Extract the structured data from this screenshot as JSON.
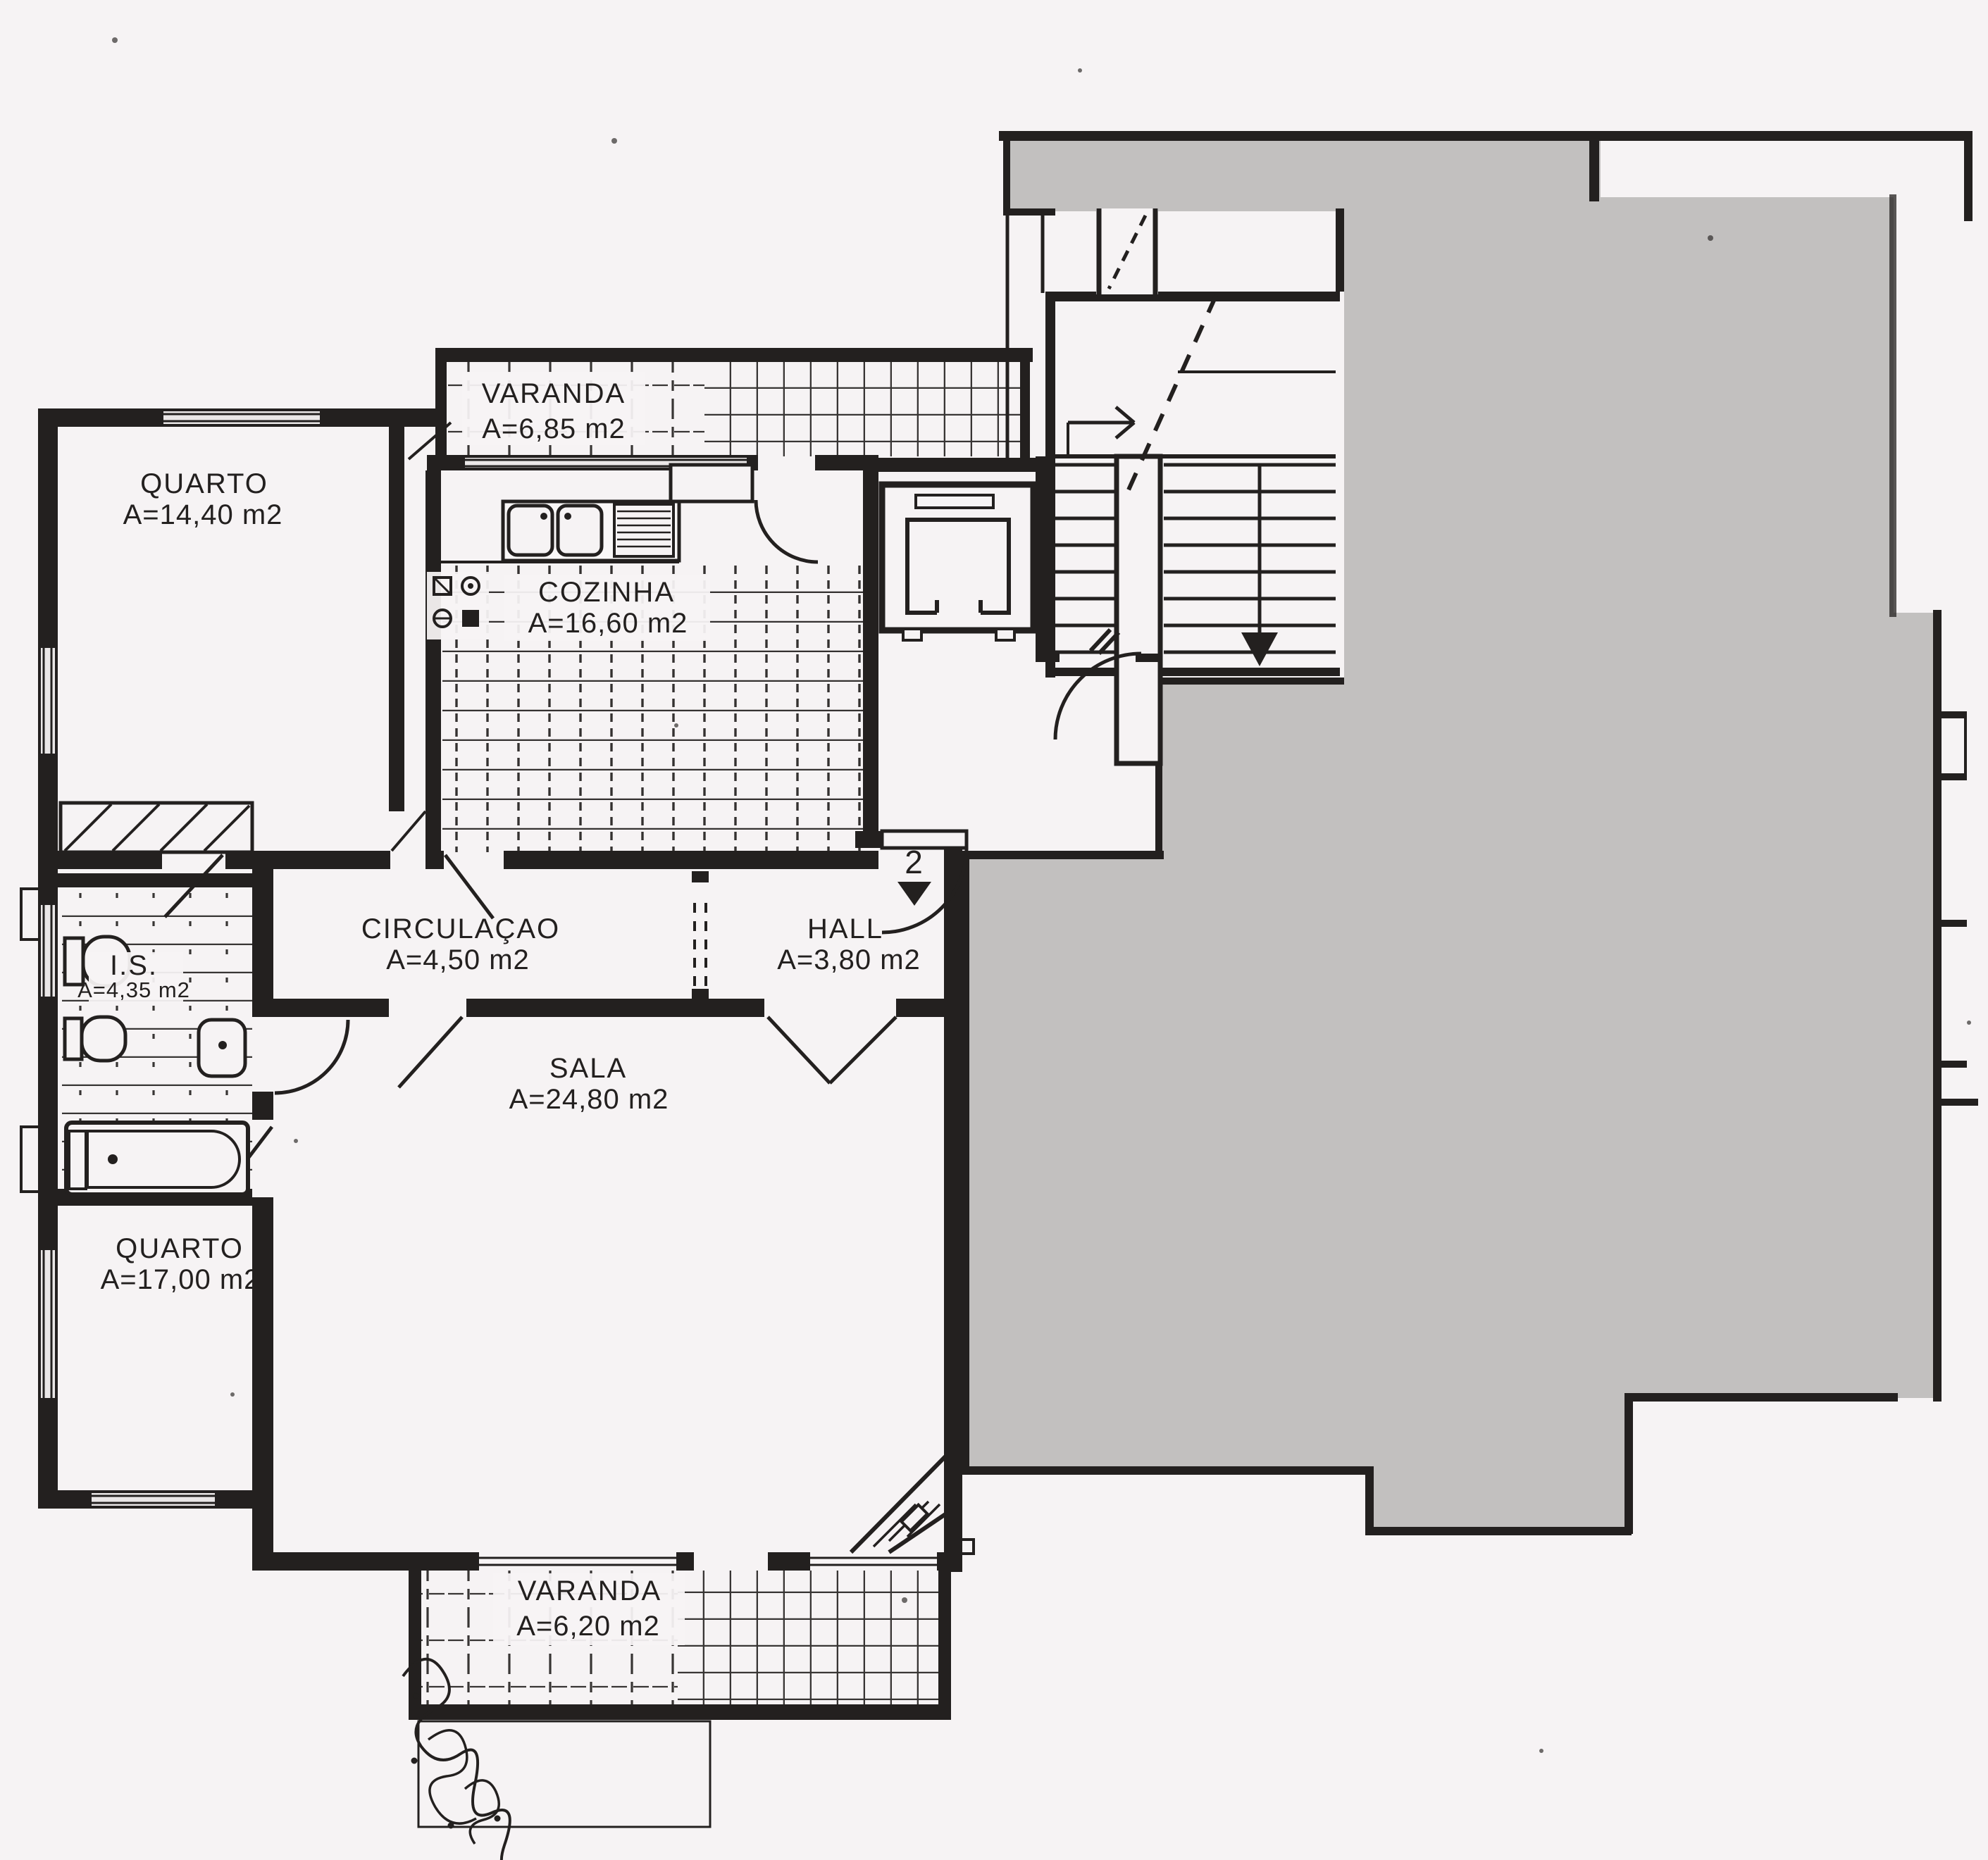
{
  "rooms": [
    {
      "id": "varanda-top",
      "name": "VARANDA",
      "area": "A=6,85 m2"
    },
    {
      "id": "quarto-1",
      "name": "QUARTO",
      "area": "A=14,40 m2"
    },
    {
      "id": "cozinha",
      "name": "COZINHA",
      "area": "A=16,60 m2"
    },
    {
      "id": "circulacao",
      "name": "CIRCULAÇAO",
      "area": "A=4,50 m2"
    },
    {
      "id": "hall",
      "name": "HALL",
      "area": "A=3,80 m2"
    },
    {
      "id": "instalacao-sanitaria",
      "name": "I.S.",
      "area": "A=4,35 m2"
    },
    {
      "id": "sala",
      "name": "SALA",
      "area": "A=24,80 m2"
    },
    {
      "id": "quarto-2",
      "name": "QUARTO",
      "area": "A=17,00 m2"
    },
    {
      "id": "varanda-bottom",
      "name": "VARANDA",
      "area": "A=6,20 m2"
    }
  ],
  "entrance": {
    "unit_number": "2"
  },
  "colors": {
    "ink": "#23201f",
    "paper": "#f6f3f4",
    "redaction": "#c2c0bf"
  }
}
